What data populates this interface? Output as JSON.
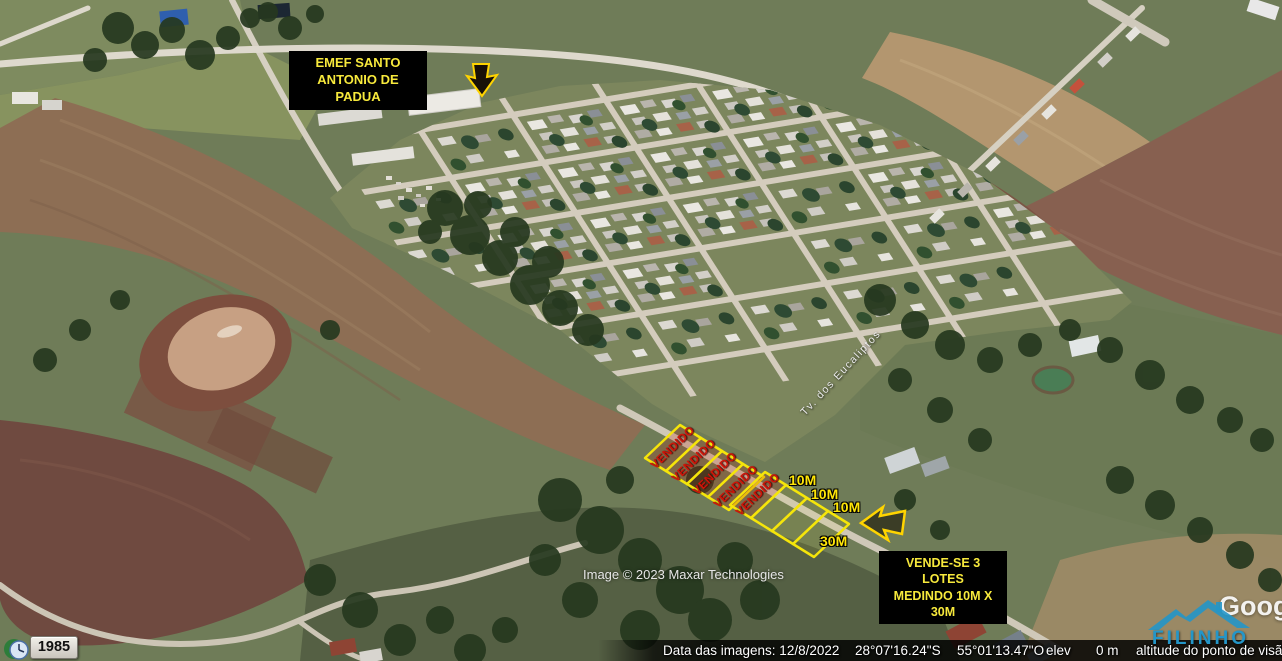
{
  "map": {
    "school_label": [
      "EMEF SANTO",
      "ANTONIO DE PADUA"
    ],
    "street_label": "Tv. dos Eucaliptos",
    "sold_label": "VENDIDO",
    "measurements": [
      "10M",
      "10M",
      "10M",
      "30M"
    ],
    "sale_box": [
      "VENDE-SE 3 LOTES",
      "MEDINDO 10M  X",
      "30M"
    ],
    "credit": "Image © 2023 Maxar Technologies"
  },
  "status_bar": {
    "imagery_date": "Data das imagens: 12/8/2022",
    "latitude": "28°07'16.24\"S",
    "longitude": "55°01'13.47\"O",
    "elevation_label": "elev",
    "elevation_value": "0 m",
    "view_altitude_label": "altitude do ponto de visão"
  },
  "history": {
    "year": "1985"
  },
  "branding": {
    "google": "Goog",
    "watermark": "FILINHO"
  },
  "colors": {
    "annotation_yellow": "#ffe608",
    "sold_red": "#cf1408",
    "label_bg": "#000000",
    "logo_blue": "#2496c8"
  }
}
